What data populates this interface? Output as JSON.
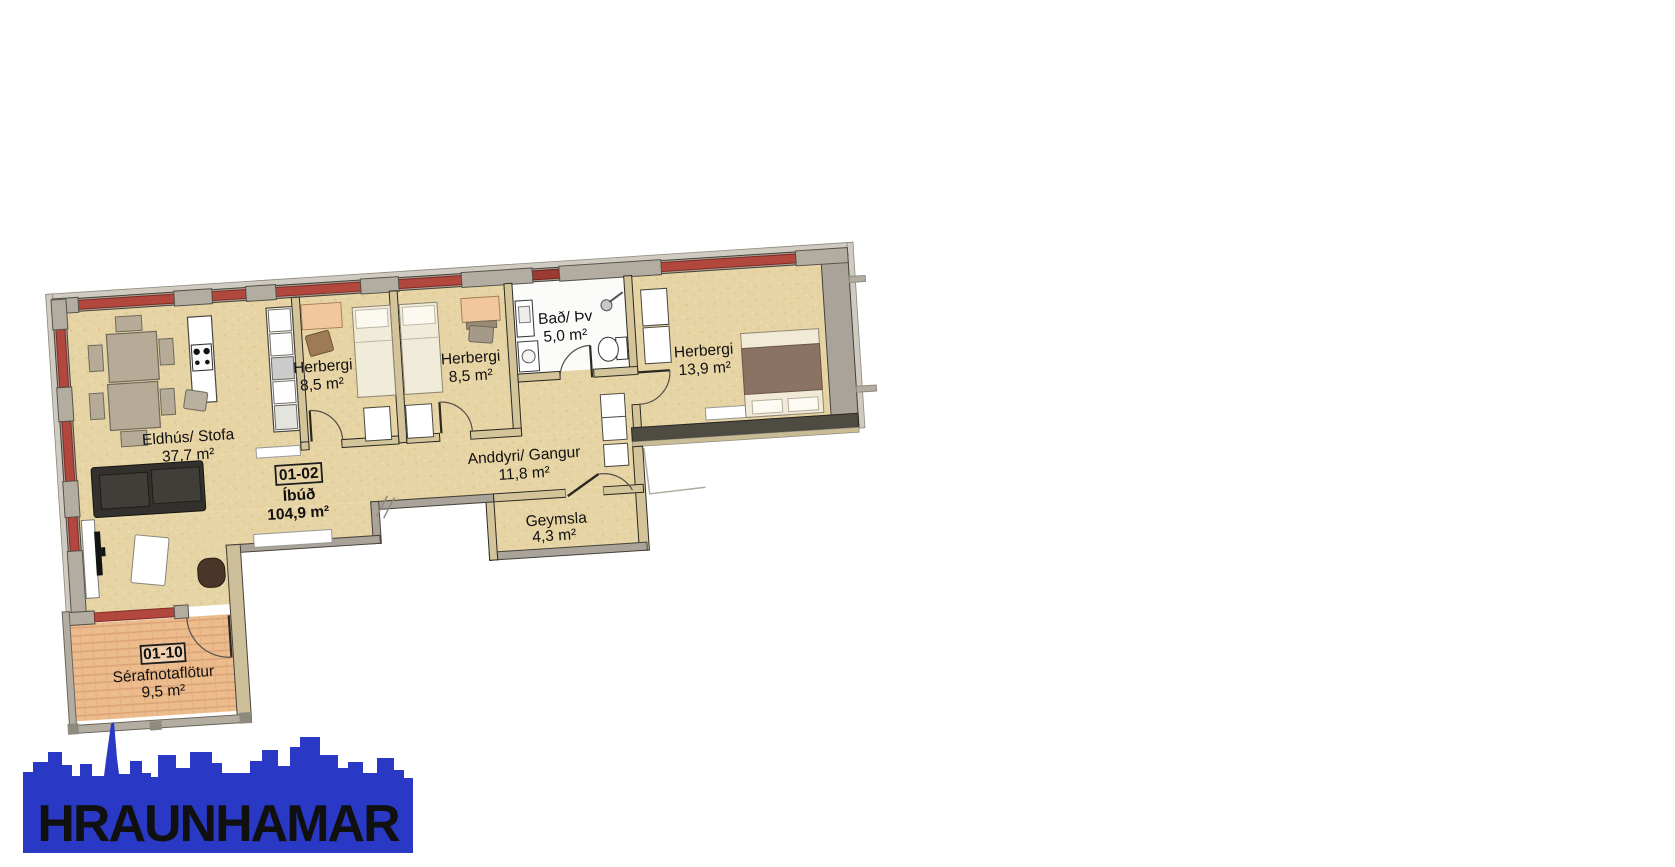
{
  "plan": {
    "unit_tag": {
      "code": "01-02",
      "name": "Íbúð",
      "area": "104,9 m²"
    },
    "outdoor_tag": {
      "code": "01-10",
      "name": "Sérafnotaflötur",
      "area": "9,5 m²"
    },
    "rooms": [
      {
        "name": "Eldhús/ Stofa",
        "area": "37,7 m²"
      },
      {
        "name": "Herbergi",
        "area": "8,5 m²"
      },
      {
        "name": "Herbergi",
        "area": "8,5 m²"
      },
      {
        "name": "Bað/ Þv",
        "area": "5,0 m²"
      },
      {
        "name": "Herbergi",
        "area": "13,9 m²"
      },
      {
        "name": "Anddyri/ Gangur",
        "area": "11,8 m²"
      },
      {
        "name": "Geymsla",
        "area": "4,3 m²"
      }
    ],
    "colors": {
      "floor": "#e7d4a4",
      "wall_gray": "#a9a399",
      "window_red": "#b2473e",
      "deck_orange": "#ecbc8d",
      "bath_floor": "#fbfbf9"
    }
  },
  "logo": {
    "text": "HRAUNHAMAR",
    "color": "#2939c5"
  }
}
